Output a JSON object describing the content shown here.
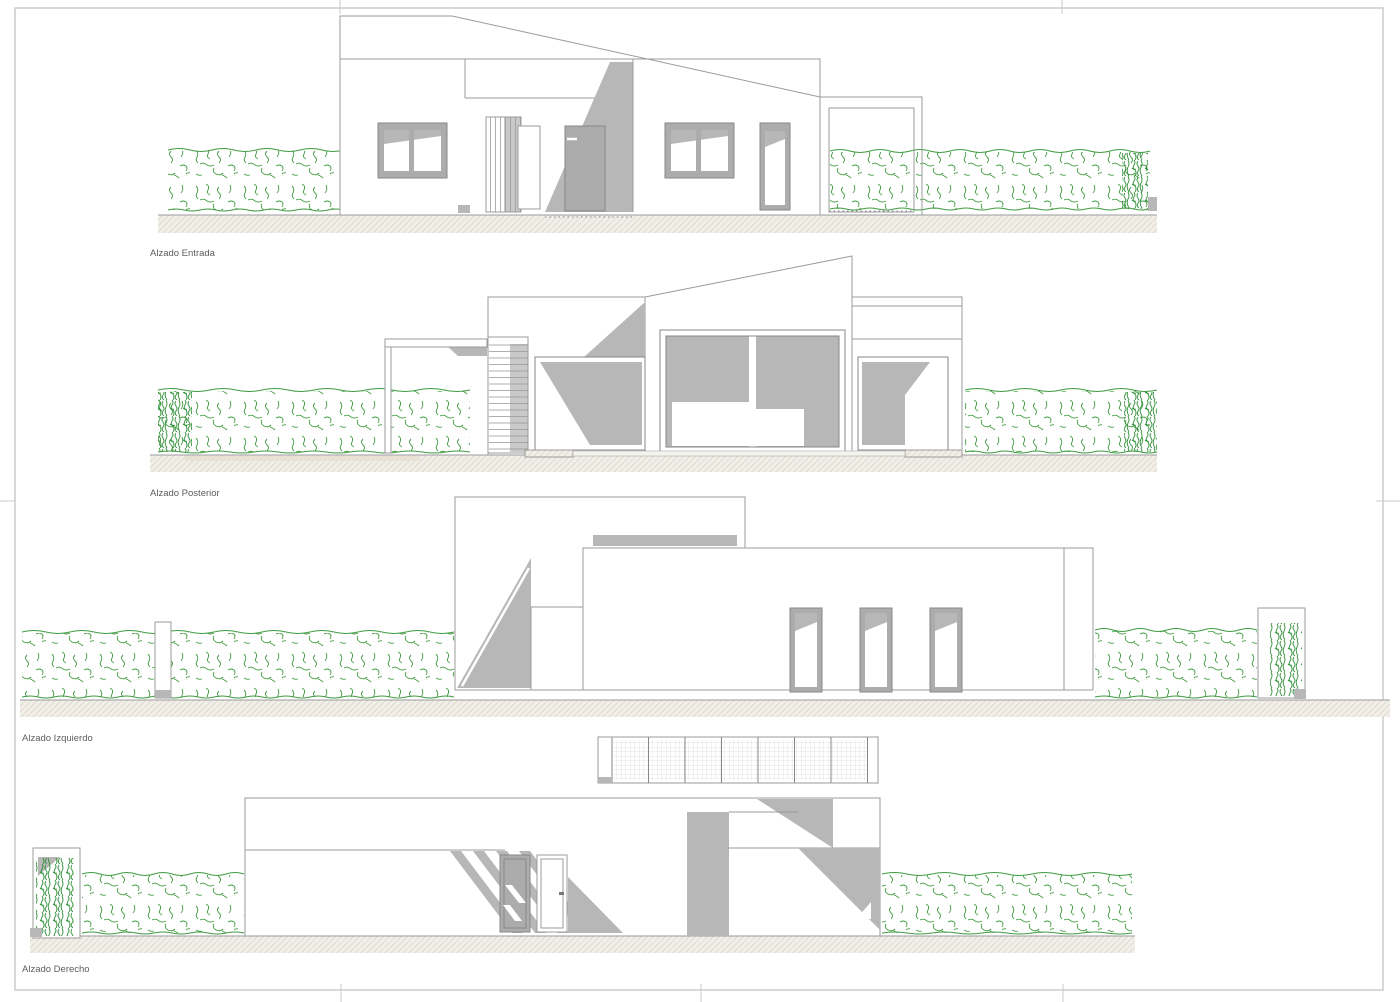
{
  "elevations": [
    {
      "id": "entrada",
      "label": "Alzado Entrada"
    },
    {
      "id": "posterior",
      "label": "Alzado Posterior"
    },
    {
      "id": "izquierdo",
      "label": "Alzado Izquierdo"
    },
    {
      "id": "derecho",
      "label": "Alzado Derecho"
    }
  ],
  "colors": {
    "line": "#9b9b9b",
    "line_dark": "#878787",
    "shadow": "#b7b7b7",
    "shadow_light": "#c9c9c9",
    "frame_fill": "#acacac",
    "hedge": "#3f9b41",
    "hedge_dark": "#2e8f36",
    "ground_fill": "#f1efe7",
    "hatch_line": "#dbd8ce",
    "mesh_line": "#c9c9c9",
    "page_frame": "#cbcbcb",
    "label_text": "#5d5d5d",
    "paper": "#ffffff"
  }
}
